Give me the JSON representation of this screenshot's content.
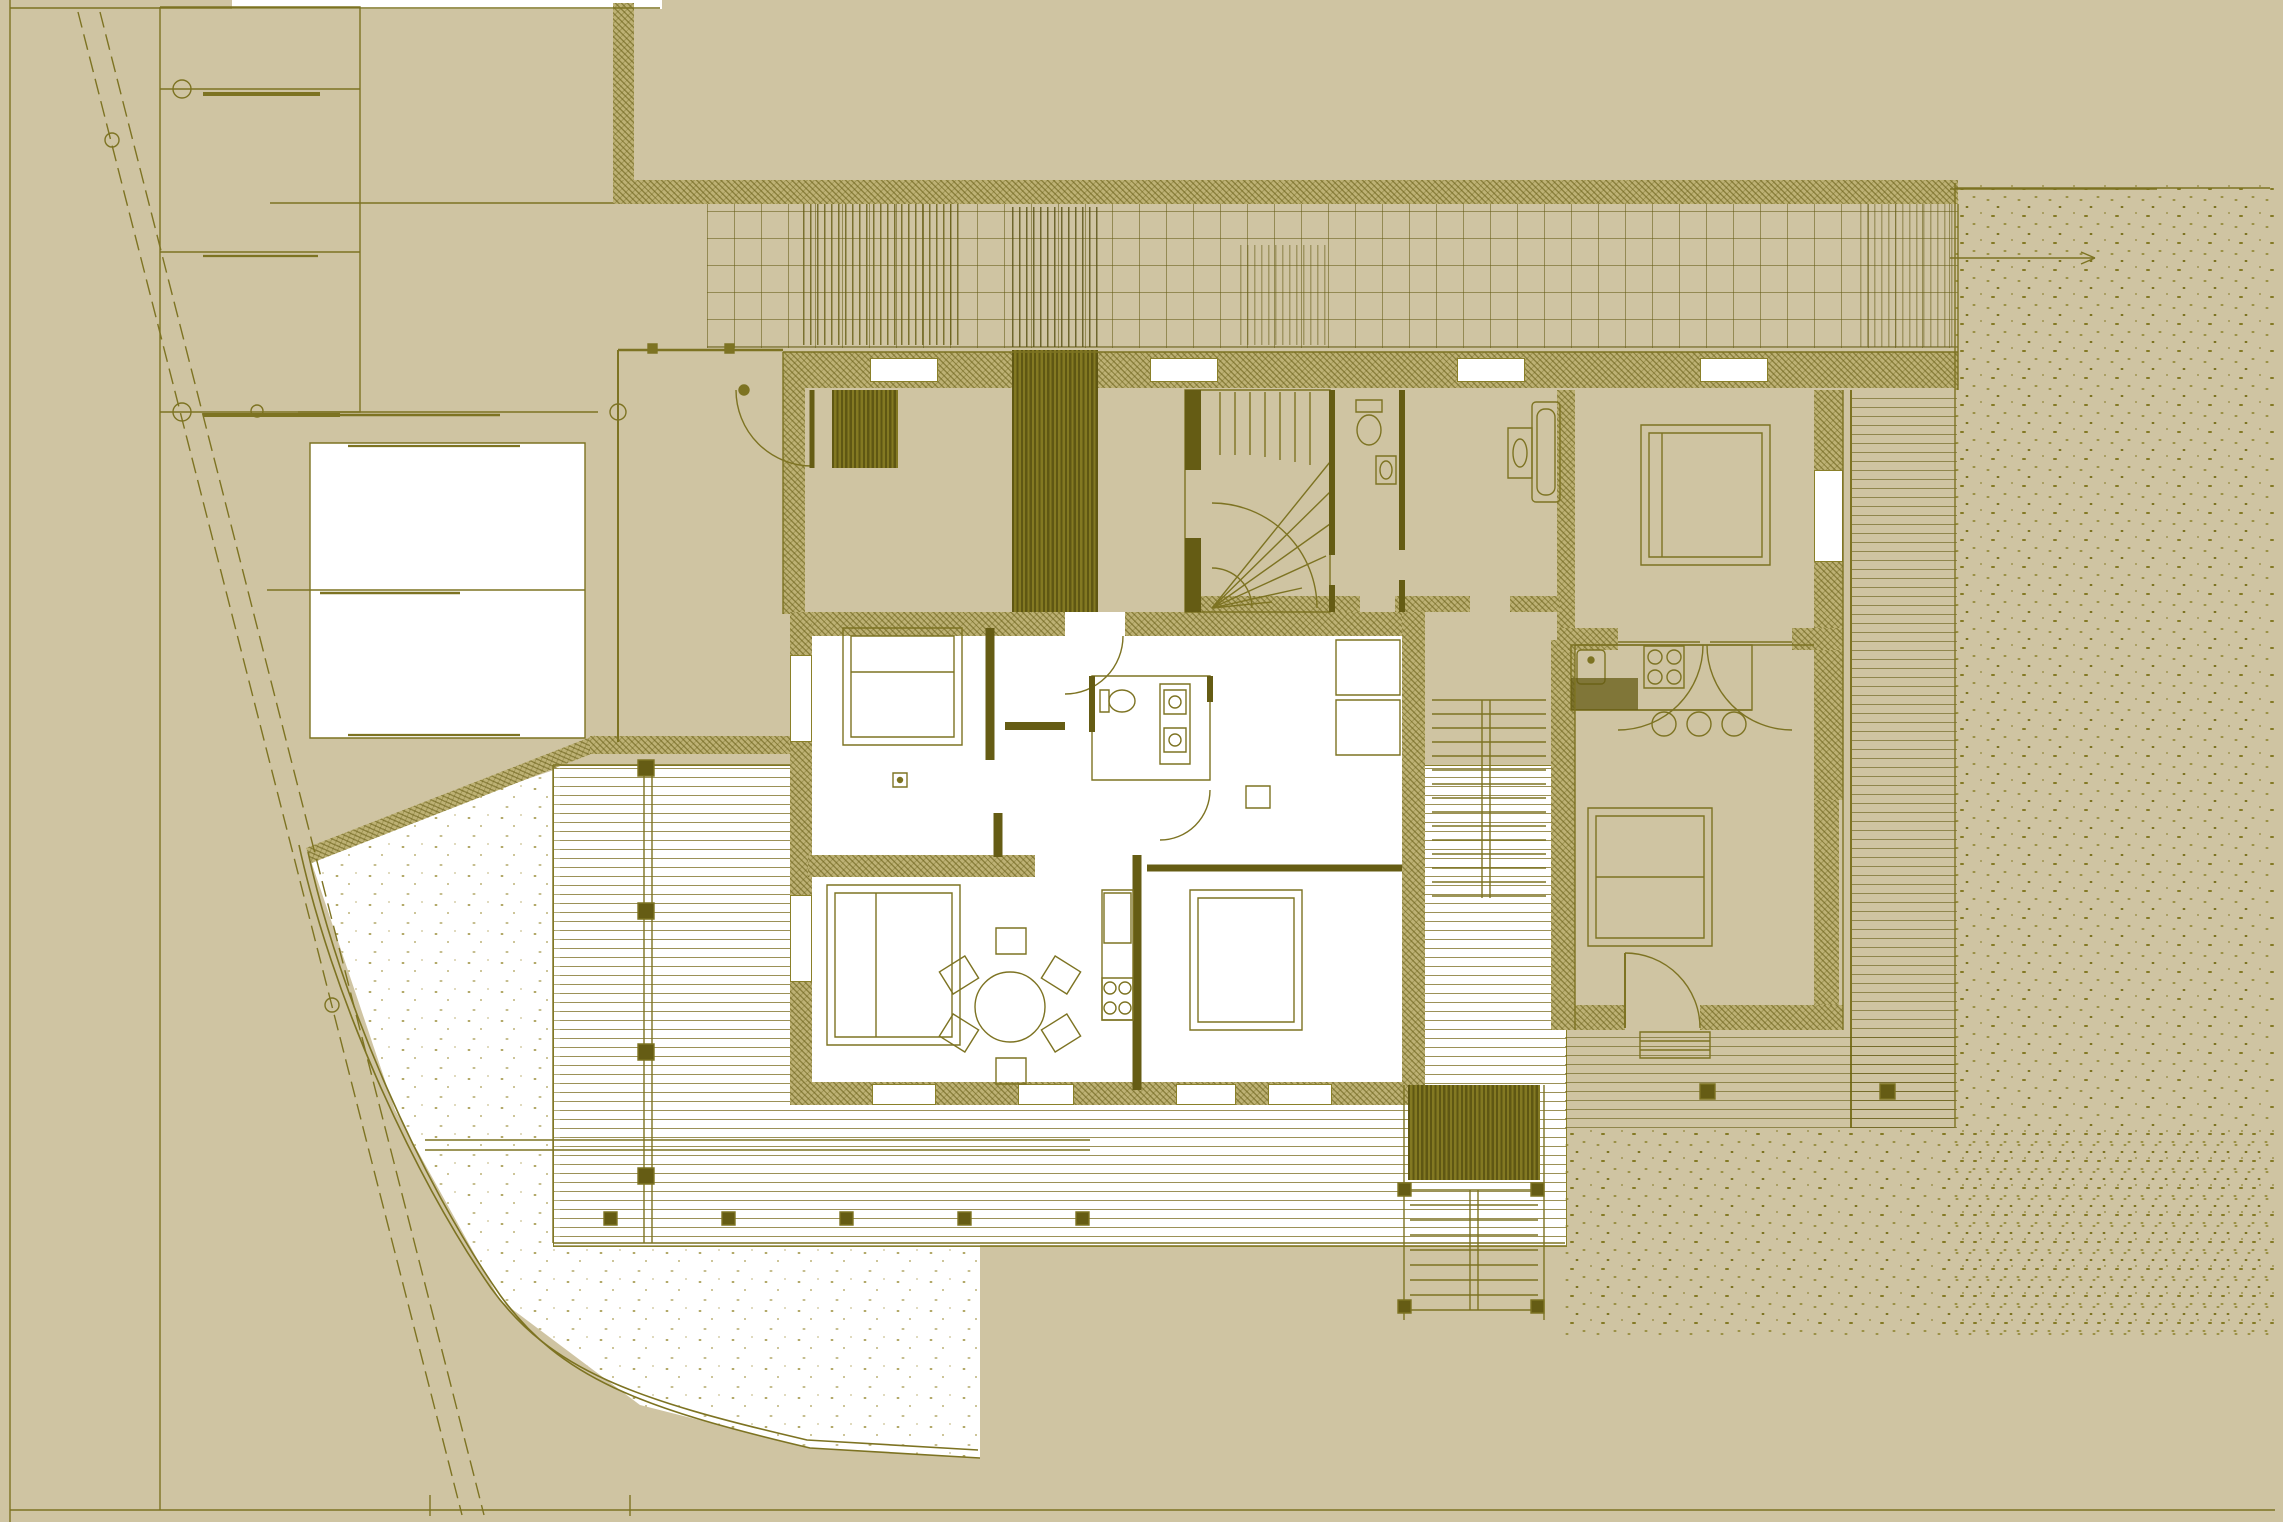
{
  "document": {
    "kind": "architectural plan drawing (site plan with ground-floor furniture layout)",
    "visible_text_labels": [],
    "palette": {
      "paper_background": "#cfc4a2",
      "line_olive": "#7d7322",
      "line_dark_olive": "#655c14",
      "wall_hatch_tone": "#bdb174",
      "floor_white": "#ffffff"
    },
    "site": {
      "boundary_road": "double dashed diagonal line, upper-left to lower-left",
      "plots_upper_left": 2,
      "white_outbuilding_plot": 1,
      "gravel_texture_areas": 3,
      "timber_deck_areas": 3,
      "pergola_grid_band_top": true
    },
    "building": {
      "units": 2,
      "rooms_white_unit": [
        "bedroom-1",
        "bedroom-2",
        "bedroom-3",
        "bathroom",
        "kitchen",
        "dining-area"
      ],
      "rooms_tan_unit": [
        "entry-porch",
        "winder-stair",
        "wc",
        "bathroom",
        "bedroom",
        "living-kitchen"
      ],
      "dining_chairs": 6,
      "dining_table_shape": "round",
      "kitchen_island_stools": 3,
      "cooktop_burners_each_kitchen": 4,
      "beds_total": 5,
      "exterior_stairs": 2,
      "chimney_block": "dark hatched rectangle at centre-top",
      "double_french_doors": 2
    }
  }
}
